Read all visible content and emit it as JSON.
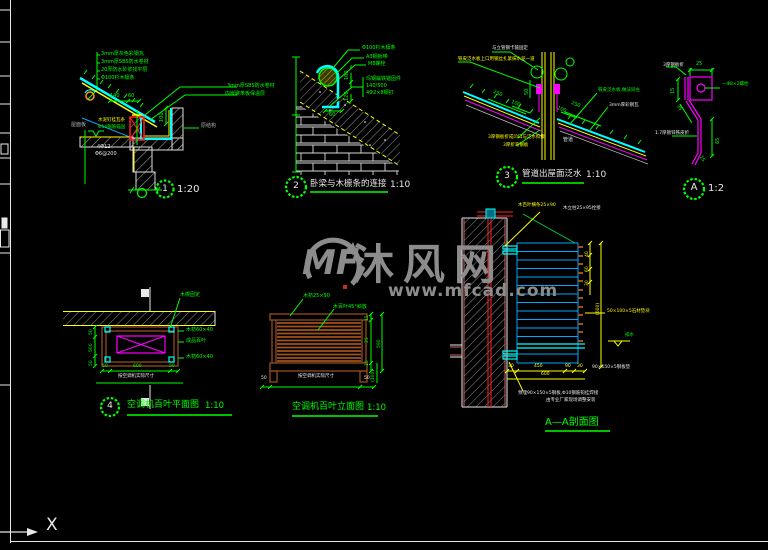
{
  "ucs": {
    "x_label": "X"
  },
  "watermark": {
    "logo": "MF",
    "brand": "沐风网",
    "url": "www.mfcad.com"
  },
  "d1": {
    "bubble": "1",
    "scale": "1:20",
    "stack0": "3mm厚灰色彩钢瓦",
    "stack1": "3mm厚SBS防水卷材",
    "stack2": "20厚防水砂浆找平层",
    "stack3": "Φ100杉木檩条",
    "right1": "3mm厚SBS防水卷材",
    "right2": "内嵌聚苯板保温层",
    "roof_board": "屋面板",
    "orig_struct": "原结构",
    "batten": "水泥钉挂瓦条",
    "rebar": "Φ14钢筋锚固",
    "note1": "4Φ12",
    "note2": "Φ6@200",
    "dim140": "140",
    "dim60": "60",
    "dim100": "100"
  },
  "d2": {
    "bubble": "2",
    "scale": "1:10",
    "title": "卧梁与木檩条的连接",
    "purlin": "Φ100杉木檩条",
    "plate": "A3钢板带",
    "bolt": "M8螺栓",
    "anchor1": "玛钢扁铁锚固件",
    "anchor2": "140/500",
    "anchor3": "4Φ2×8钢钉",
    "dim60": "60",
    "dim100": "100",
    "dim120": "120"
  },
  "d3": {
    "bubble": "3",
    "scale": "1:10",
    "title": "管道出屋面泛水",
    "top1": "与立管钢卡箍固定",
    "top2": "铁皮泛水板上口用钢丝扎紧抹水泥一道",
    "right1": "铁皮泛水板,做法同左",
    "right2": "3mm厚彩钢瓦",
    "bot1": "3厚钢板折成凹口与泛水扣接",
    "bot2": "3厚折弯钢板",
    "pipe": "管道",
    "dim250l": "250",
    "dim100l": "100",
    "dim250r": "250",
    "dim100r": "100",
    "dim50": "50"
  },
  "dA": {
    "bubble": "A",
    "scale": "1:2",
    "plate": "3厚钢板折",
    "bolt1": "—Φ8×2螺栓",
    "bolt2": "中距350锚固",
    "sheet": "1.7厚镀锌铁皮折",
    "dim25": "25",
    "dim15a": "15",
    "dim35": "35",
    "dim65": "65",
    "dim15b": "15"
  },
  "d4": {
    "bubble": "4",
    "scale": "1:10",
    "title": "空调机百叶平面图",
    "wedge": "木楔固定",
    "r1": "木枋60×40",
    "r2": "成品百叶",
    "r3": "木枋60×40",
    "note": "按空调机实际尺寸",
    "bdim_a": "50",
    "bdim_b": "600",
    "bdim_c": "50",
    "ldim_a": "50",
    "ldim_b": "500",
    "ldim_c": "50"
  },
  "d5": {
    "scale": "1:10",
    "title": "空调机百叶立面图",
    "top1": "木枋25×90",
    "top2": "木百叶45°斜放",
    "note": "按空调机实际尺寸",
    "dim15a": "15",
    "dim25": "25",
    "dim15b": "15",
    "dim590": "590",
    "dim100": "(100)",
    "dim50l": "50",
    "dim50r": "50"
  },
  "d6": {
    "title": "A—A剖面图",
    "top1": "木百叶横条25×90",
    "top2": "木立柱25×95拴接",
    "block": "50×100×5石材垫块",
    "drain": "排水",
    "plate": "90×150×5钢板垫",
    "note1": "预埋90×150×5钢板,Φ10钢筋钩挂焊接",
    "note2": "由专业厂家现场调整安装",
    "dim40": "40",
    "dim60": "60",
    "dim30": "30",
    "dim600v": "(600)",
    "b1": "30",
    "b2": "450",
    "b3": "90",
    "b4": "30",
    "b_total": "600"
  }
}
